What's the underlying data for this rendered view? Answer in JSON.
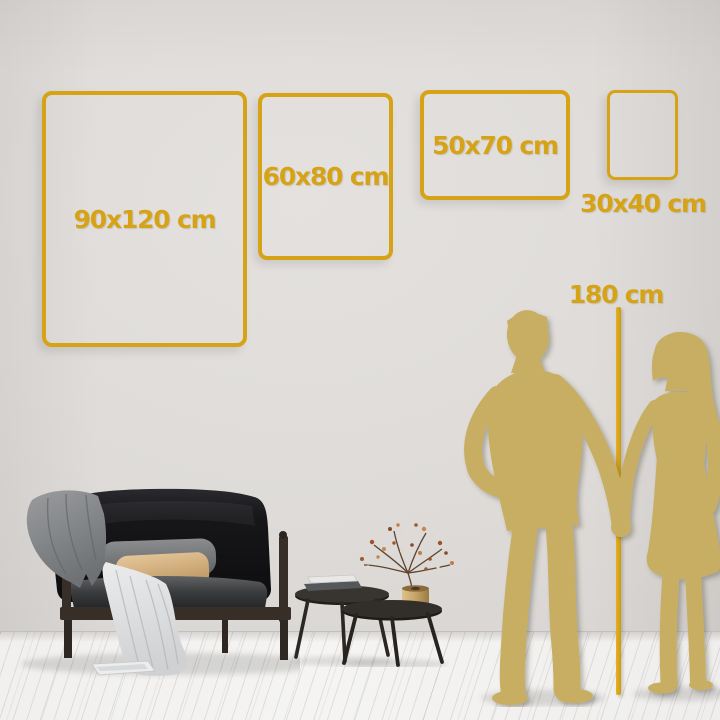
{
  "size_guide": {
    "frames": [
      {
        "label": "90x120 cm"
      },
      {
        "label": "60x80 cm"
      },
      {
        "label": "50x70 cm"
      },
      {
        "label": "30x40 cm"
      }
    ],
    "height_reference_label": "180 cm"
  },
  "colors": {
    "gold_accent": "#d7a316",
    "silhouette_gold": "#c8ae62",
    "wall": "#dedbd8",
    "floor": "#f3f2f0",
    "sofa_black": "#141416",
    "tan_pillow": "#d9b98d"
  }
}
